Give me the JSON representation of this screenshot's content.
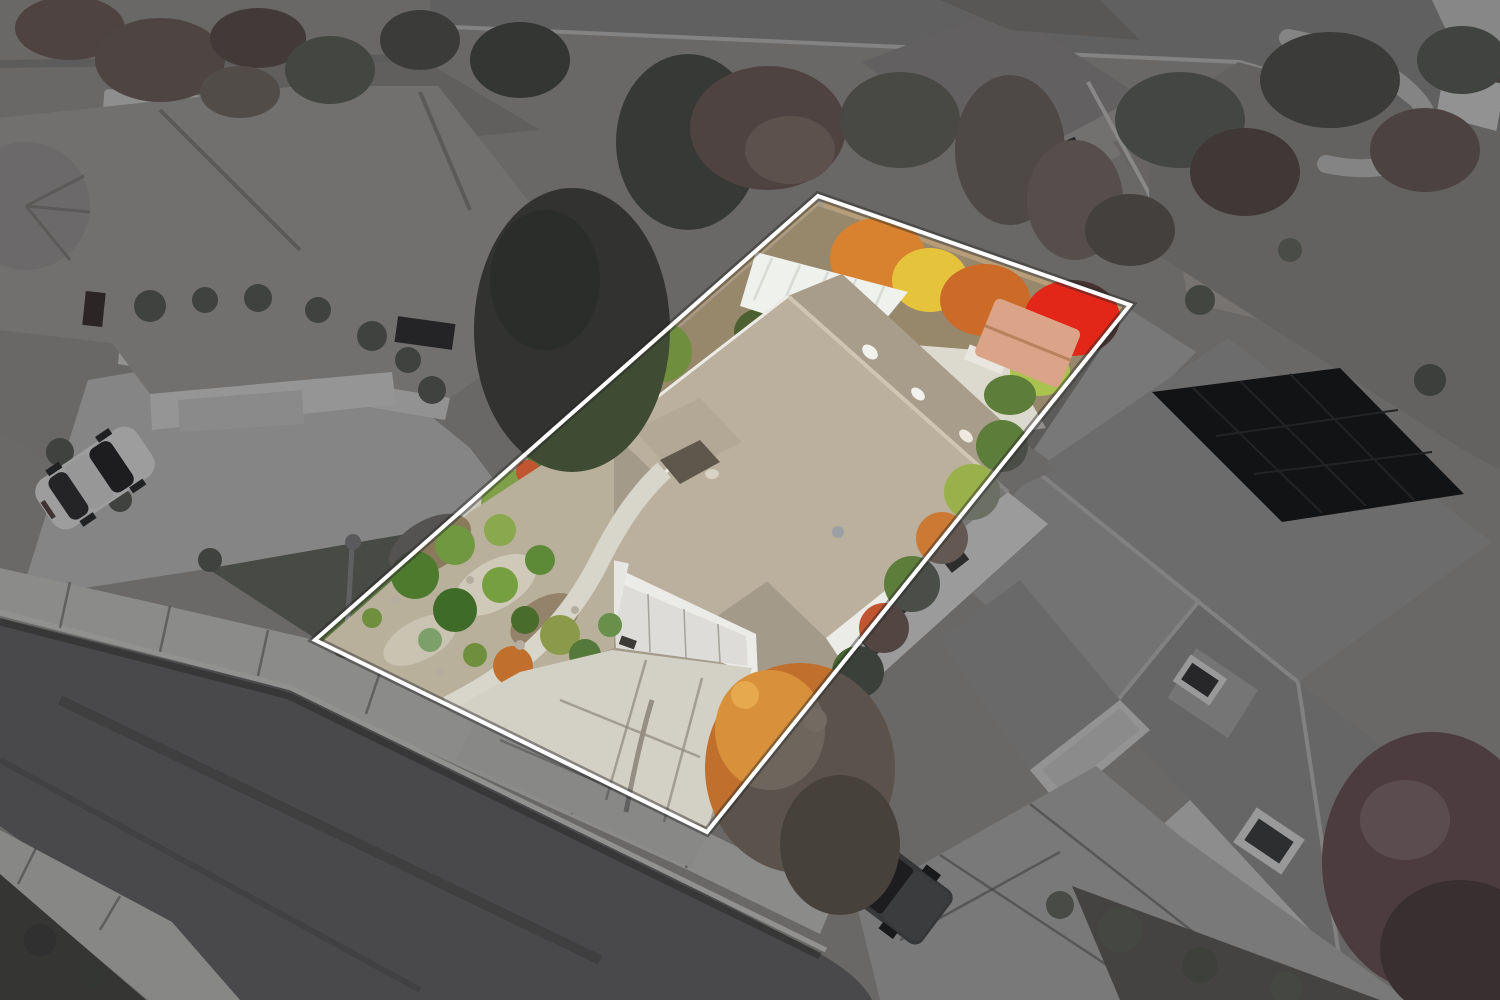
{
  "image": {
    "type": "aerial-drone-real-estate-photo",
    "description": "Overhead aerial photo of a suburban single-story home; the subject parcel is shown in full color and outlined in white, while surrounding properties and street are darkened and desaturated.",
    "width": 1500,
    "height": 1000
  },
  "property_highlight": {
    "boundary_points": "315,640 818,196 1130,305 707,832",
    "outside_clip_path": "M0 0H1500V1000H0Z M315 640L818 196L1130 305L707 832Z",
    "line_color": "#ffffff",
    "line_shadow": "rgba(40,40,40,0.45)",
    "dim_style": "filter:brightness(0.78) saturate(0.18)"
  },
  "scene": {
    "objects": [
      "subject house with tan tile roof",
      "white garage door",
      "concrete driveway",
      "front rock garden with shrubs",
      "backyard autumn trees",
      "hot tub with tan cover",
      "white patio cover",
      "wood fence",
      "side hedge",
      "left neighbor house",
      "white sedan",
      "street lamp",
      "street with sidewalks",
      "right neighbor house with solar panels",
      "gray pickup truck",
      "red maple tree",
      "white van",
      "curved garden path"
    ]
  },
  "palette": {
    "ground": "#a39a8a",
    "asphalt": "#6c6c6e",
    "asphalt_top": "#8e8e8a",
    "sidewalk": "#d6d2c6",
    "sidewalk_far": "#cfccc0",
    "curb_line": "#dedbd0",
    "planting_dark": "#4e4c40",
    "lawn": "#5e7442",
    "rock_strip": "#a79c88",
    "drive_left": "#ccc9bf",
    "roof_left": "#b2a797",
    "wall_light": "#e3e2dc",
    "garage_door_left": "#d2d1cb",
    "door_red": "#5e2a26",
    "skylight": "#2f3338",
    "pergola_white": "#d7d8d2",
    "conifer": "#3f4c33",
    "tree_green": "#5c6b44",
    "tree_green_bright": "#6f8f3e",
    "tree_lime": "#aac24e",
    "tree_yellow": "#e6c33c",
    "tree_orange": "#d8822f",
    "tree_orange_deep": "#c0702c",
    "tree_red": "#e22718",
    "maple_dusty": "#b05331",
    "maple_crimson": "#c2404e",
    "gravel_yard": "#b9b09c",
    "rock_light": "#cfc9b9",
    "mulch": "#8a7a5c",
    "dirt_back": "#97876b",
    "gravel_back": "#9b9180",
    "fence_wood": "#b79e79",
    "patio_cover": "#eff1ed",
    "hot_tub": "#dba387",
    "hot_tub_edge": "#b9825f",
    "roof_subject": "#bbb09d",
    "roof_subject_dark": "#a89d8a",
    "wall_white": "#ebebe7",
    "garage_door": "#dddcd8",
    "drive_subject": "#d3d0c6",
    "walk_concrete": "#d8d5cb",
    "porch_shadow": "#5f574c",
    "hedge_green": "#5d7d3a",
    "hedge_olive": "#9ab04a",
    "hedge_orange": "#cc7a33",
    "hedge_red": "#c05530",
    "roof_right": "#a5a29a",
    "roof_right_light": "#b0ada5",
    "roof_right_dark": "#9c9991",
    "ridge_light": "#c6c3bb",
    "solar": "#14171c",
    "solar_grid": "#2b3038",
    "window_dark": "#33373a",
    "window_frame": "#e8e8e4",
    "drive_right": "#b8b6ae",
    "truck_body": "#4b4e52",
    "truck_bed": "#33362f",
    "glass_dark": "#23272c",
    "car_body": "#eeeeec",
    "lamp_metal": "#8f9092",
    "roof_back_house": "#9c8f7c",
    "roof_topright": "#a6957b",
    "wall_tan": "#c0ac8c",
    "van_white": "#dcdcda",
    "path_back": "#ccc8bc",
    "patio_pad": "#dcd9cf",
    "stone_tan": "#b09468"
  }
}
